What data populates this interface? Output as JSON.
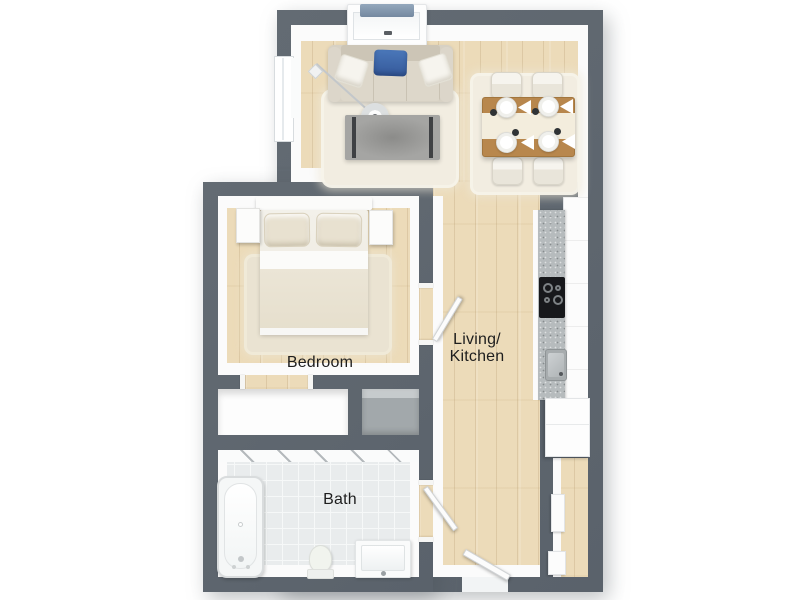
{
  "floorplan": {
    "type": "apartment-floor-plan-3d-top-view",
    "labels": {
      "living_kitchen_line1": "Living/",
      "living_kitchen_line2": "Kitchen",
      "bedroom": "Bedroom",
      "bath": "Bath"
    },
    "colors": {
      "wall": "#5e666e",
      "wood_floor": "#ecdbb9",
      "tile_floor": "#e9eced",
      "trim": "#fbfbfb",
      "rug": "#f2ede1",
      "sofa": "#d7d1c4",
      "accent_pillow_blue": "#3b66a9",
      "dining_table_wood": "#b8874d",
      "counter": "#b6bbbd",
      "cooktop": "#17181b",
      "utility_closet_gray": "#a2a8ab"
    },
    "furniture": [
      "tv-console",
      "sofa",
      "floor-lamp",
      "coffee-table",
      "living-rug",
      "dining-rug",
      "dining-table",
      "dining-chairs",
      "place-settings",
      "kitchen-cabinets",
      "kitchen-counter",
      "cooktop",
      "kitchen-sink",
      "fridge",
      "hall-cabinets",
      "bed",
      "bed-pillows",
      "nightstands",
      "bedroom-rug",
      "wardrobe-closet",
      "utility-closet",
      "bathtub",
      "toilet",
      "bathroom-sink",
      "entry-door",
      "bedroom-door",
      "bathroom-door",
      "window"
    ]
  }
}
